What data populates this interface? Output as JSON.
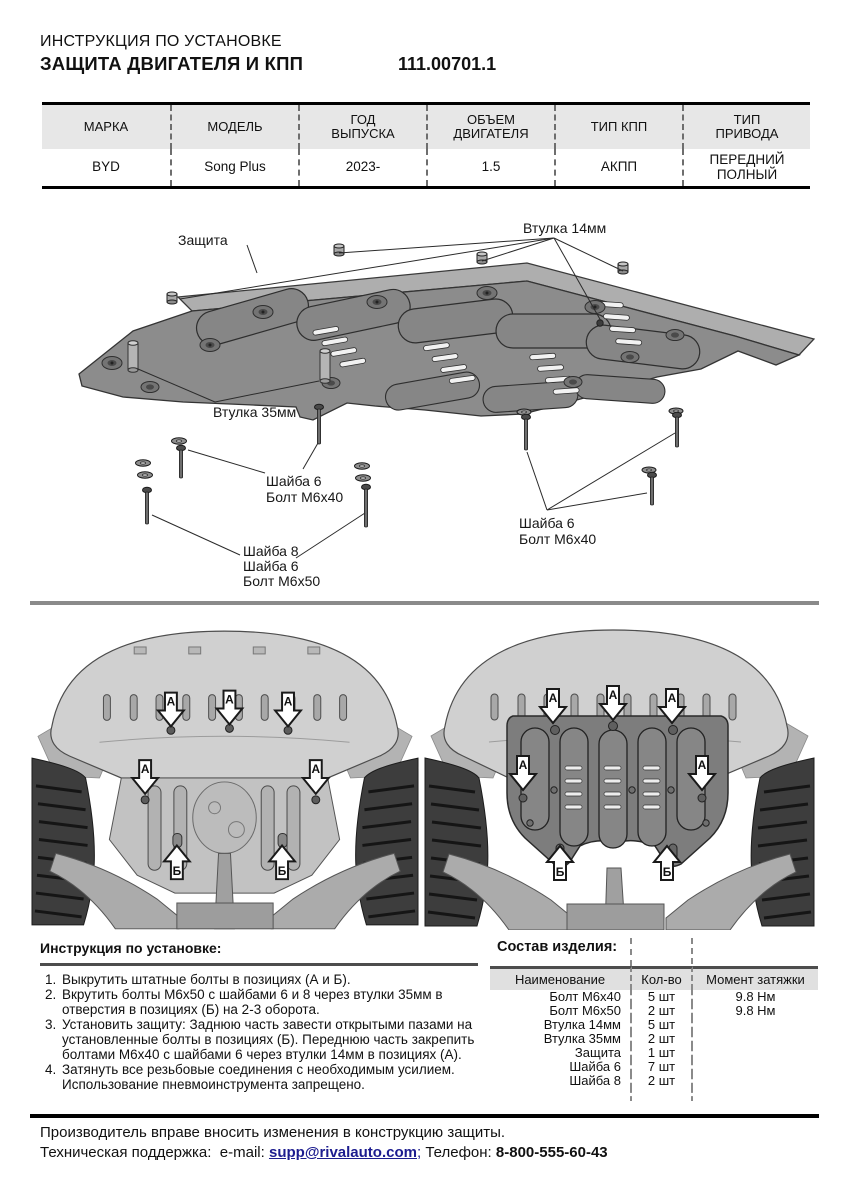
{
  "header": {
    "subtitle": "ИНСТРУКЦИЯ ПО УСТАНОВКЕ",
    "title": "ЗАЩИТА ДВИГАТЕЛЯ И КПП",
    "doc_number": "111.00701.1"
  },
  "vehicle_table": {
    "columns": [
      "МАРКА",
      "МОДЕЛЬ",
      "ГОД\nВЫПУСКА",
      "ОБЪЕМ\nДВИГАТЕЛЯ",
      "ТИП КПП",
      "ТИП\nПРИВОДА"
    ],
    "row": [
      "BYD",
      "Song Plus",
      "2023-",
      "1.5",
      "АКПП",
      "ПЕРЕДНИЙ\nПОЛНЫЙ"
    ]
  },
  "diagram": {
    "labels": {
      "shield": "Защита",
      "bushing14": "Втулка 14мм",
      "bushing35": "Втулка 35мм",
      "washer6": "Шайба 6",
      "washer8": "Шайба 8",
      "bolt_m6x40": "Болт М6х40",
      "bolt_m6x50": "Болт М6х50"
    }
  },
  "position_markers": {
    "a": "А",
    "b": "Б"
  },
  "instructions": {
    "title": "Инструкция по установке:",
    "steps": [
      "Выкрутить штатные болты в позициях (А и Б).",
      "Вкрутить болты М6х50 с шайбами 6 и 8 через втулки 35мм в отверстия в позициях (Б) на 2-3 оборота.",
      "Установить защиту: Заднюю часть завести открытыми пазами на установленные болты в позициях (Б). Переднюю часть закрепить болтами М6х40 с шайбами 6 через втулки 14мм в позициях (А).",
      "Затянуть все резьбовые соединения с необходимым усилием. Использование пневмоинструмента запрещено."
    ]
  },
  "parts": {
    "title": "Состав изделия:",
    "columns": [
      "Наименование",
      "Кол-во",
      "Момент затяжки"
    ],
    "rows": [
      {
        "name": "Болт М6х40",
        "qty": "5 шт",
        "torque": "9.8 Нм"
      },
      {
        "name": "Болт М6х50",
        "qty": "2 шт",
        "torque": "9.8 Нм"
      },
      {
        "name": "Втулка 14мм",
        "qty": "5 шт",
        "torque": ""
      },
      {
        "name": "Втулка 35мм",
        "qty": "2 шт",
        "torque": ""
      },
      {
        "name": "Защита",
        "qty": "1 шт",
        "torque": ""
      },
      {
        "name": "Шайба 6",
        "qty": "7 шт",
        "torque": ""
      },
      {
        "name": "Шайба 8",
        "qty": "2 шт",
        "torque": ""
      }
    ]
  },
  "footer": {
    "line1": "Производитель вправе вносить изменения в конструкцию защиты.",
    "support_label": "Техническая поддержка:",
    "email_label": "e-mail:",
    "email": "supp@rivalauto.com",
    "separator": ";",
    "phone_label": "Телефон:",
    "phone": "8-800-555-60-43"
  },
  "colors": {
    "link": "#1c1c8f",
    "table_header_bg": "#e7e7e7",
    "divider_gray": "#8a8a8a",
    "rule_dark": "#4d4d4d",
    "plate_body": "#8c8c8c",
    "plate_flange": "#aeaeae"
  }
}
